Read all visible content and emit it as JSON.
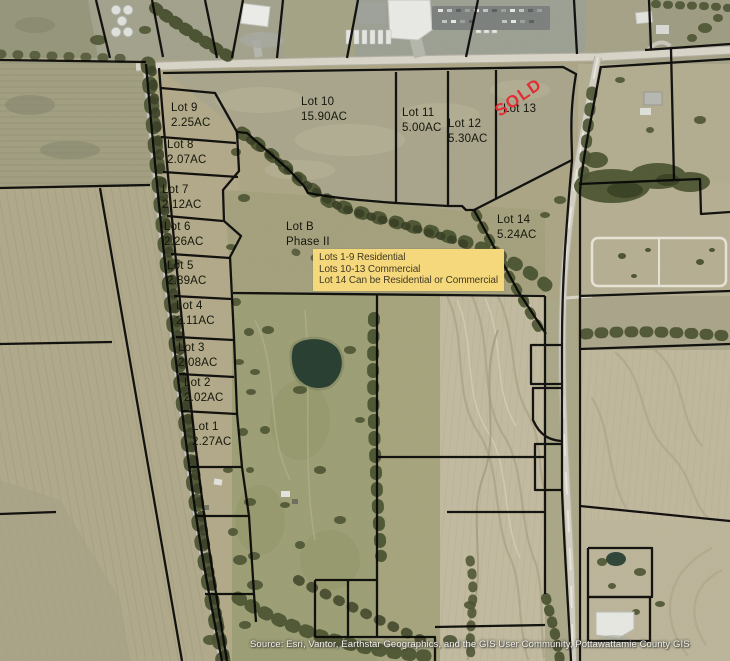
{
  "title": "Lot plat aerial map",
  "lots": [
    {
      "name": "Lot 1",
      "area": "2.27AC"
    },
    {
      "name": "Lot 2",
      "area": "2.02AC"
    },
    {
      "name": "Lot 3",
      "area": "2.08AC"
    },
    {
      "name": "Lot 4",
      "area": "2.11AC"
    },
    {
      "name": "Lot 5",
      "area": "2.89AC"
    },
    {
      "name": "Lot 6",
      "area": "2.26AC"
    },
    {
      "name": "Lot 7",
      "area": "2.12AC"
    },
    {
      "name": "Lot 8",
      "area": "2.07AC"
    },
    {
      "name": "Lot 9",
      "area": "2.25AC"
    },
    {
      "name": "Lot 10",
      "area": "15.90AC"
    },
    {
      "name": "Lot 11",
      "area": "5.00AC"
    },
    {
      "name": "Lot 12",
      "area": "5.30AC"
    },
    {
      "name": "Lot 13"
    },
    {
      "name": "Lot 14",
      "area": "5.24AC"
    }
  ],
  "lot_b": {
    "name": "Lot B",
    "phase": "Phase II"
  },
  "sold_badge": "SOLD",
  "info_box": {
    "line1": "Lots 1-9 Residential",
    "line2": "Lots 10-13 Commercial",
    "line3": "Lot 14 Can be Residential or Commercial"
  },
  "attribution": "Source: Esri, Vantor, Earthstar Geographics, and the GIS User Community, Pottawattamie County GIS",
  "colors": {
    "sold_red": "#e02f35",
    "info_bg": "#f6d87c",
    "boundary": "#000000"
  }
}
